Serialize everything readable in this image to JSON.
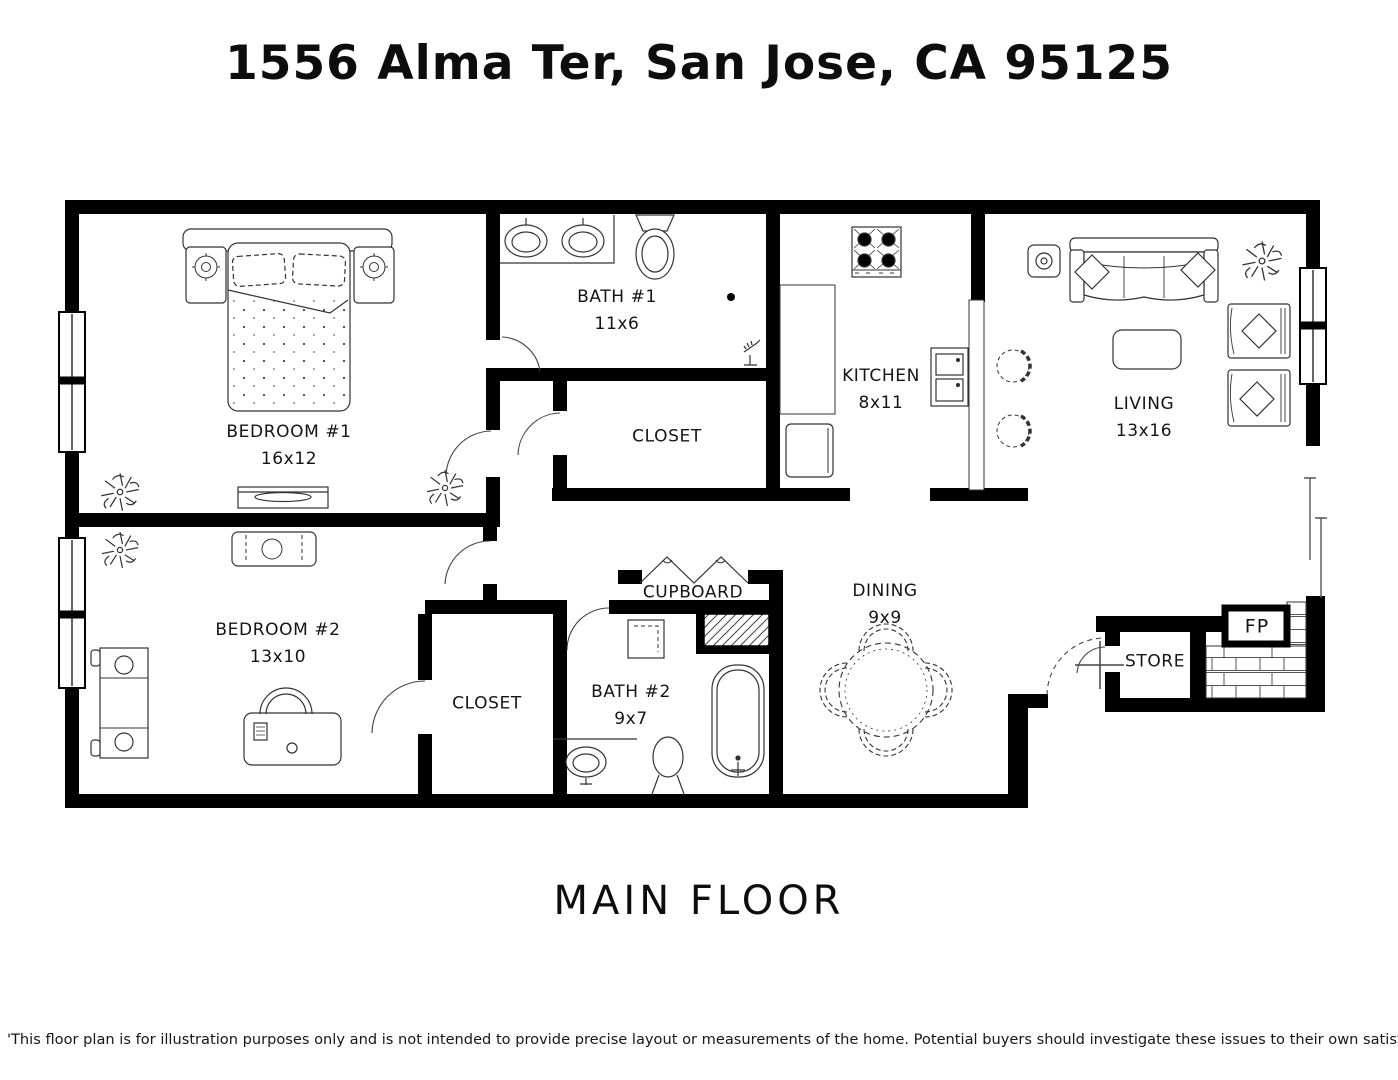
{
  "page": {
    "title": "1556 Alma Ter, San Jose, CA 95125",
    "floor_label": "MAIN FLOOR",
    "disclaimer": "'This floor plan is for illustration purposes only and is not intended to provide precise layout or measurements of the home. Potential buyers should investigate these issues to their own satisfaction. '"
  },
  "colors": {
    "walls": "#000000",
    "background": "#ffffff",
    "furniture_line": "#3d3d3d",
    "text": "#141414"
  },
  "rooms": {
    "bedroom1": {
      "label": "BEDROOM #1",
      "dims": "16x12"
    },
    "bath1": {
      "label": "BATH #1",
      "dims": "11x6"
    },
    "closet1": {
      "label": "CLOSET"
    },
    "kitchen": {
      "label": "KITCHEN",
      "dims": "8x11"
    },
    "living": {
      "label": "LIVING",
      "dims": "13x16"
    },
    "bedroom2": {
      "label": "BEDROOM #2",
      "dims": "13x10"
    },
    "closet2": {
      "label": "CLOSET"
    },
    "cupboard": {
      "label": "CUPBOARD"
    },
    "bath2": {
      "label": "BATH #2",
      "dims": "9x7"
    },
    "dining": {
      "label": "DINING",
      "dims": "9x9"
    },
    "store": {
      "label": "STORE"
    },
    "fireplace": {
      "label": "FP"
    }
  },
  "fixtures": [
    "double-bed",
    "nightstand-lamps",
    "dresser",
    "double-sink-vanity",
    "toilet",
    "shower-head",
    "stove-4-burner",
    "kitchen-double-sink",
    "refrigerator",
    "breakfast-bar",
    "bar-stools",
    "sofa-with-pillows",
    "coffee-table",
    "armchairs",
    "stereo-speaker",
    "house-plants",
    "bench",
    "writing-desk",
    "desk-chair",
    "vanity-sink",
    "bathtub",
    "round-dining-table",
    "dining-chairs",
    "bi-fold-cupboard-doors",
    "brick-fireplace",
    "windows",
    "door-swings"
  ]
}
